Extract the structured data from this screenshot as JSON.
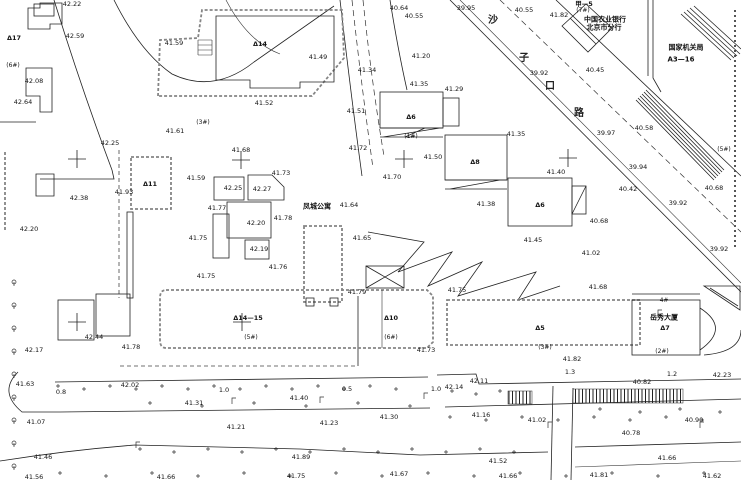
{
  "map": {
    "type": "topographic-survey-cad-plan",
    "street_name": "沙子口路",
    "colors": {
      "background": "#ffffff",
      "line": "#222222",
      "compound_wall": "#858585"
    }
  },
  "street_chars": [
    {
      "t": "沙",
      "x": 493,
      "y": 21
    },
    {
      "t": "子",
      "x": 524,
      "y": 59
    },
    {
      "t": "口",
      "x": 550,
      "y": 87
    },
    {
      "t": "路",
      "x": 579,
      "y": 114
    }
  ],
  "place_names": [
    {
      "t": "中国农业银行",
      "x": 605,
      "y": 20
    },
    {
      "t": "北京市分行",
      "x": 604,
      "y": 28
    },
    {
      "t": "国家机关局",
      "x": 686,
      "y": 48
    },
    {
      "t": "A3—16",
      "x": 681,
      "y": 60
    },
    {
      "t": "凤城公寓",
      "x": 317,
      "y": 207
    },
    {
      "t": "岳秀大厦",
      "x": 664,
      "y": 318
    }
  ],
  "annotations": [
    {
      "t": "42.22",
      "x": 72,
      "y": 4
    },
    {
      "t": "42.59",
      "x": 75,
      "y": 36
    },
    {
      "t": "Δ17",
      "x": 14,
      "y": 38,
      "k": "bldg"
    },
    {
      "t": "41.59",
      "x": 174,
      "y": 43
    },
    {
      "t": "(6#)",
      "x": 13,
      "y": 66,
      "k": "parcel"
    },
    {
      "t": "42.08",
      "x": 34,
      "y": 81
    },
    {
      "t": "42.64",
      "x": 23,
      "y": 102
    },
    {
      "t": "(3#)",
      "x": 203,
      "y": 123,
      "k": "parcel"
    },
    {
      "t": "41.61",
      "x": 175,
      "y": 131
    },
    {
      "t": "42.25",
      "x": 110,
      "y": 143
    },
    {
      "t": "Δ14",
      "x": 260,
      "y": 44,
      "k": "bldg"
    },
    {
      "t": "41.49",
      "x": 318,
      "y": 57
    },
    {
      "t": "41.52",
      "x": 264,
      "y": 103
    },
    {
      "t": "41.51",
      "x": 356,
      "y": 111
    },
    {
      "t": "40.64",
      "x": 399,
      "y": 8
    },
    {
      "t": "40.55",
      "x": 414,
      "y": 16
    },
    {
      "t": "39.95",
      "x": 466,
      "y": 8
    },
    {
      "t": "41.34",
      "x": 367,
      "y": 70
    },
    {
      "t": "41.20",
      "x": 421,
      "y": 56
    },
    {
      "t": "41.35",
      "x": 419,
      "y": 84
    },
    {
      "t": "41.29",
      "x": 454,
      "y": 89
    },
    {
      "t": "Δ6",
      "x": 411,
      "y": 117,
      "k": "bldg"
    },
    {
      "t": "(1#)",
      "x": 411,
      "y": 137,
      "k": "parcel"
    },
    {
      "t": "41.72",
      "x": 358,
      "y": 148
    },
    {
      "t": "41.50",
      "x": 433,
      "y": 157
    },
    {
      "t": "41.70",
      "x": 392,
      "y": 177
    },
    {
      "t": "41.64",
      "x": 349,
      "y": 205
    },
    {
      "t": "41.65",
      "x": 362,
      "y": 238
    },
    {
      "t": "41.79",
      "x": 357,
      "y": 292
    },
    {
      "t": "41.68",
      "x": 241,
      "y": 150
    },
    {
      "t": "41.73",
      "x": 281,
      "y": 173
    },
    {
      "t": "41.59",
      "x": 196,
      "y": 178
    },
    {
      "t": "42.25",
      "x": 233,
      "y": 188
    },
    {
      "t": "42.27",
      "x": 262,
      "y": 189
    },
    {
      "t": "41.77",
      "x": 217,
      "y": 208
    },
    {
      "t": "42.20",
      "x": 256,
      "y": 223
    },
    {
      "t": "41.78",
      "x": 283,
      "y": 218
    },
    {
      "t": "41.75",
      "x": 198,
      "y": 238
    },
    {
      "t": "42.19",
      "x": 259,
      "y": 249
    },
    {
      "t": "41.76",
      "x": 278,
      "y": 267
    },
    {
      "t": "41.75",
      "x": 206,
      "y": 276
    },
    {
      "t": "Δ11",
      "x": 150,
      "y": 184,
      "k": "bldg"
    },
    {
      "t": "41.93",
      "x": 124,
      "y": 192
    },
    {
      "t": "42.38",
      "x": 79,
      "y": 198
    },
    {
      "t": "42.20",
      "x": 29,
      "y": 229
    },
    {
      "t": "40.55",
      "x": 524,
      "y": 10
    },
    {
      "t": "41.82",
      "x": 559,
      "y": 15
    },
    {
      "t": "甲—5",
      "x": 584,
      "y": 4,
      "k": "bldg"
    },
    {
      "t": "(7#)",
      "x": 583,
      "y": 11,
      "k": "parcel"
    },
    {
      "t": "39.92",
      "x": 539,
      "y": 73
    },
    {
      "t": "40.45",
      "x": 595,
      "y": 70
    },
    {
      "t": "40.58",
      "x": 644,
      "y": 128
    },
    {
      "t": "39.97",
      "x": 606,
      "y": 133
    },
    {
      "t": "41.35",
      "x": 516,
      "y": 134
    },
    {
      "t": "(5#)",
      "x": 724,
      "y": 150,
      "k": "parcel"
    },
    {
      "t": "41.40",
      "x": 556,
      "y": 172
    },
    {
      "t": "39.94",
      "x": 638,
      "y": 167
    },
    {
      "t": "40.42",
      "x": 628,
      "y": 189
    },
    {
      "t": "39.92",
      "x": 678,
      "y": 203
    },
    {
      "t": "40.68",
      "x": 714,
      "y": 188
    },
    {
      "t": "41.38",
      "x": 486,
      "y": 204
    },
    {
      "t": "Δ8",
      "x": 475,
      "y": 162,
      "k": "bldg"
    },
    {
      "t": "Δ6",
      "x": 540,
      "y": 205,
      "k": "bldg"
    },
    {
      "t": "40.68",
      "x": 599,
      "y": 221
    },
    {
      "t": "41.45",
      "x": 533,
      "y": 240
    },
    {
      "t": "39.92",
      "x": 719,
      "y": 249
    },
    {
      "t": "41.02",
      "x": 591,
      "y": 253
    },
    {
      "t": "41.68",
      "x": 598,
      "y": 287
    },
    {
      "t": "41.75",
      "x": 457,
      "y": 290
    },
    {
      "t": "Δ14—15",
      "x": 248,
      "y": 318,
      "k": "bldg"
    },
    {
      "t": "(5#)",
      "x": 251,
      "y": 338,
      "k": "parcel"
    },
    {
      "t": "Δ10",
      "x": 391,
      "y": 318,
      "k": "bldg"
    },
    {
      "t": "(6#)",
      "x": 391,
      "y": 338,
      "k": "parcel"
    },
    {
      "t": "Δ5",
      "x": 540,
      "y": 328,
      "k": "bldg"
    },
    {
      "t": "(3#)",
      "x": 545,
      "y": 348,
      "k": "parcel"
    },
    {
      "t": "(2#)",
      "x": 662,
      "y": 352,
      "k": "parcel"
    },
    {
      "t": "4#",
      "x": 664,
      "y": 301,
      "k": "parcel"
    },
    {
      "t": "Δ7",
      "x": 665,
      "y": 328,
      "k": "bldg"
    },
    {
      "t": "41.73",
      "x": 426,
      "y": 350
    },
    {
      "t": "41.82",
      "x": 572,
      "y": 359
    },
    {
      "t": "1.3",
      "x": 570,
      "y": 372,
      "k": "dim"
    },
    {
      "t": "1.2",
      "x": 672,
      "y": 374,
      "k": "dim"
    },
    {
      "t": "42.23",
      "x": 722,
      "y": 375
    },
    {
      "t": "42.11",
      "x": 479,
      "y": 381
    },
    {
      "t": "42.14",
      "x": 454,
      "y": 387
    },
    {
      "t": "1.0",
      "x": 436,
      "y": 389,
      "k": "dim"
    },
    {
      "t": "40.82",
      "x": 642,
      "y": 382
    },
    {
      "t": "41.16",
      "x": 481,
      "y": 415
    },
    {
      "t": "41.02",
      "x": 537,
      "y": 420
    },
    {
      "t": "40.90",
      "x": 694,
      "y": 420
    },
    {
      "t": "40.78",
      "x": 631,
      "y": 433
    },
    {
      "t": "41.52",
      "x": 498,
      "y": 461
    },
    {
      "t": "41.66",
      "x": 667,
      "y": 458
    },
    {
      "t": "41.66",
      "x": 508,
      "y": 476
    },
    {
      "t": "41.81",
      "x": 599,
      "y": 475
    },
    {
      "t": "41.62",
      "x": 712,
      "y": 476
    },
    {
      "t": "42.44",
      "x": 94,
      "y": 337
    },
    {
      "t": "42.17",
      "x": 34,
      "y": 350
    },
    {
      "t": "41.78",
      "x": 131,
      "y": 347
    },
    {
      "t": "41.63",
      "x": 25,
      "y": 384
    },
    {
      "t": "42.02",
      "x": 130,
      "y": 385
    },
    {
      "t": "0.8",
      "x": 61,
      "y": 392,
      "k": "dim"
    },
    {
      "t": "1.0",
      "x": 224,
      "y": 390,
      "k": "dim"
    },
    {
      "t": "0.5",
      "x": 347,
      "y": 389,
      "k": "dim"
    },
    {
      "t": "41.40",
      "x": 299,
      "y": 398
    },
    {
      "t": "41.31",
      "x": 194,
      "y": 403
    },
    {
      "t": "41.21",
      "x": 236,
      "y": 427
    },
    {
      "t": "41.23",
      "x": 329,
      "y": 423
    },
    {
      "t": "41.30",
      "x": 389,
      "y": 417
    },
    {
      "t": "41.07",
      "x": 36,
      "y": 422
    },
    {
      "t": "41.46",
      "x": 43,
      "y": 457
    },
    {
      "t": "41.89",
      "x": 301,
      "y": 457
    },
    {
      "t": "41.56",
      "x": 34,
      "y": 477
    },
    {
      "t": "41.66",
      "x": 166,
      "y": 477
    },
    {
      "t": "41.75",
      "x": 296,
      "y": 476
    },
    {
      "t": "41.67",
      "x": 399,
      "y": 474
    }
  ],
  "survey_crosses": [
    {
      "x": 77,
      "y": 159
    },
    {
      "x": 241,
      "y": 160
    },
    {
      "x": 404,
      "y": 159
    },
    {
      "x": 568,
      "y": 158
    },
    {
      "x": 77,
      "y": 322
    },
    {
      "x": 242,
      "y": 322
    }
  ]
}
